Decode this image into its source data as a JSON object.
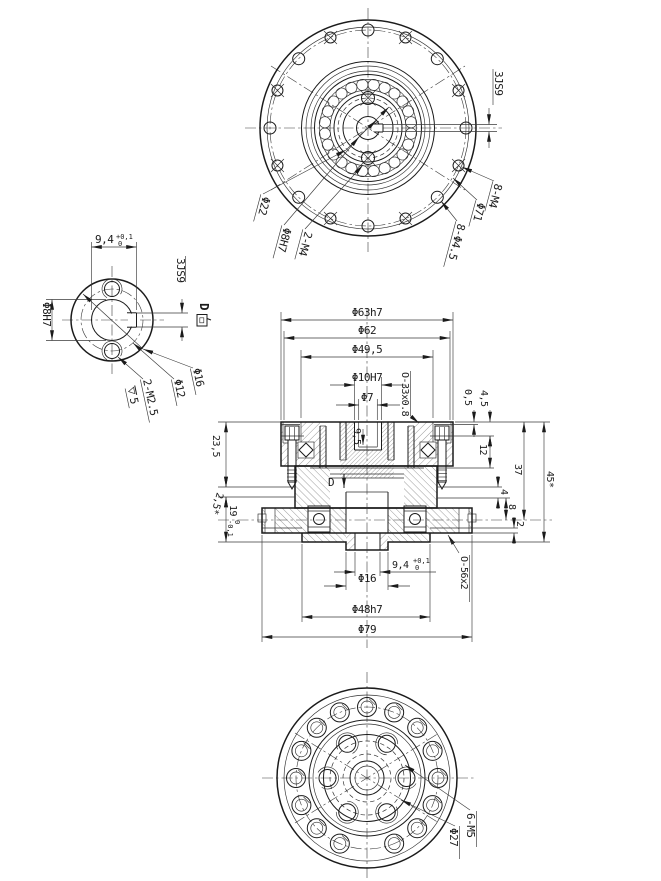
{
  "top_view": {
    "slot": "3JS9",
    "d22": "Φ22",
    "bore": "Φ8H7",
    "tap_center": "2-M4",
    "tap_outer": "8-M4",
    "bolt_circle": "Φ71",
    "holes": "8-Φ4.5"
  },
  "d_view": {
    "title_letter": "D",
    "title": "D 向",
    "width": "9,4",
    "width_tol_upper": "+0,1",
    "width_tol_lower": "0",
    "slot": "3JS9",
    "bore": "Φ8H7",
    "outer": "Φ16",
    "pitch": "Φ12",
    "tap": "2-M2.5",
    "tap_depth": "5"
  },
  "section_view": {
    "d63": "Φ63h7",
    "d62": "Φ62",
    "d49_5": "Φ49,5",
    "d10": "Φ10H7",
    "d7": "Φ7",
    "oring_top": "O-33x0.8",
    "depth9_5": "9,5",
    "s0_5": "0,5",
    "s4_5": "4,5",
    "s12": "12",
    "s4": "4",
    "s8": "8",
    "s2": "2",
    "s37": "37",
    "s45": "45*",
    "s23_5": "23,5",
    "s2_5": "2,5*",
    "s19": "19",
    "s19_tol_upper": "0",
    "s19_tol_lower": "-0,1",
    "key_width": "9,4",
    "key_tol_upper": "+0,1",
    "key_tol_lower": "0",
    "d16": "Φ16",
    "d48": "Φ48h7",
    "d79": "Φ79",
    "oring_bottom": "O-56x2",
    "view_marker": "D"
  },
  "bottom_view": {
    "tap": "6-M5",
    "pitch": "Φ27"
  }
}
